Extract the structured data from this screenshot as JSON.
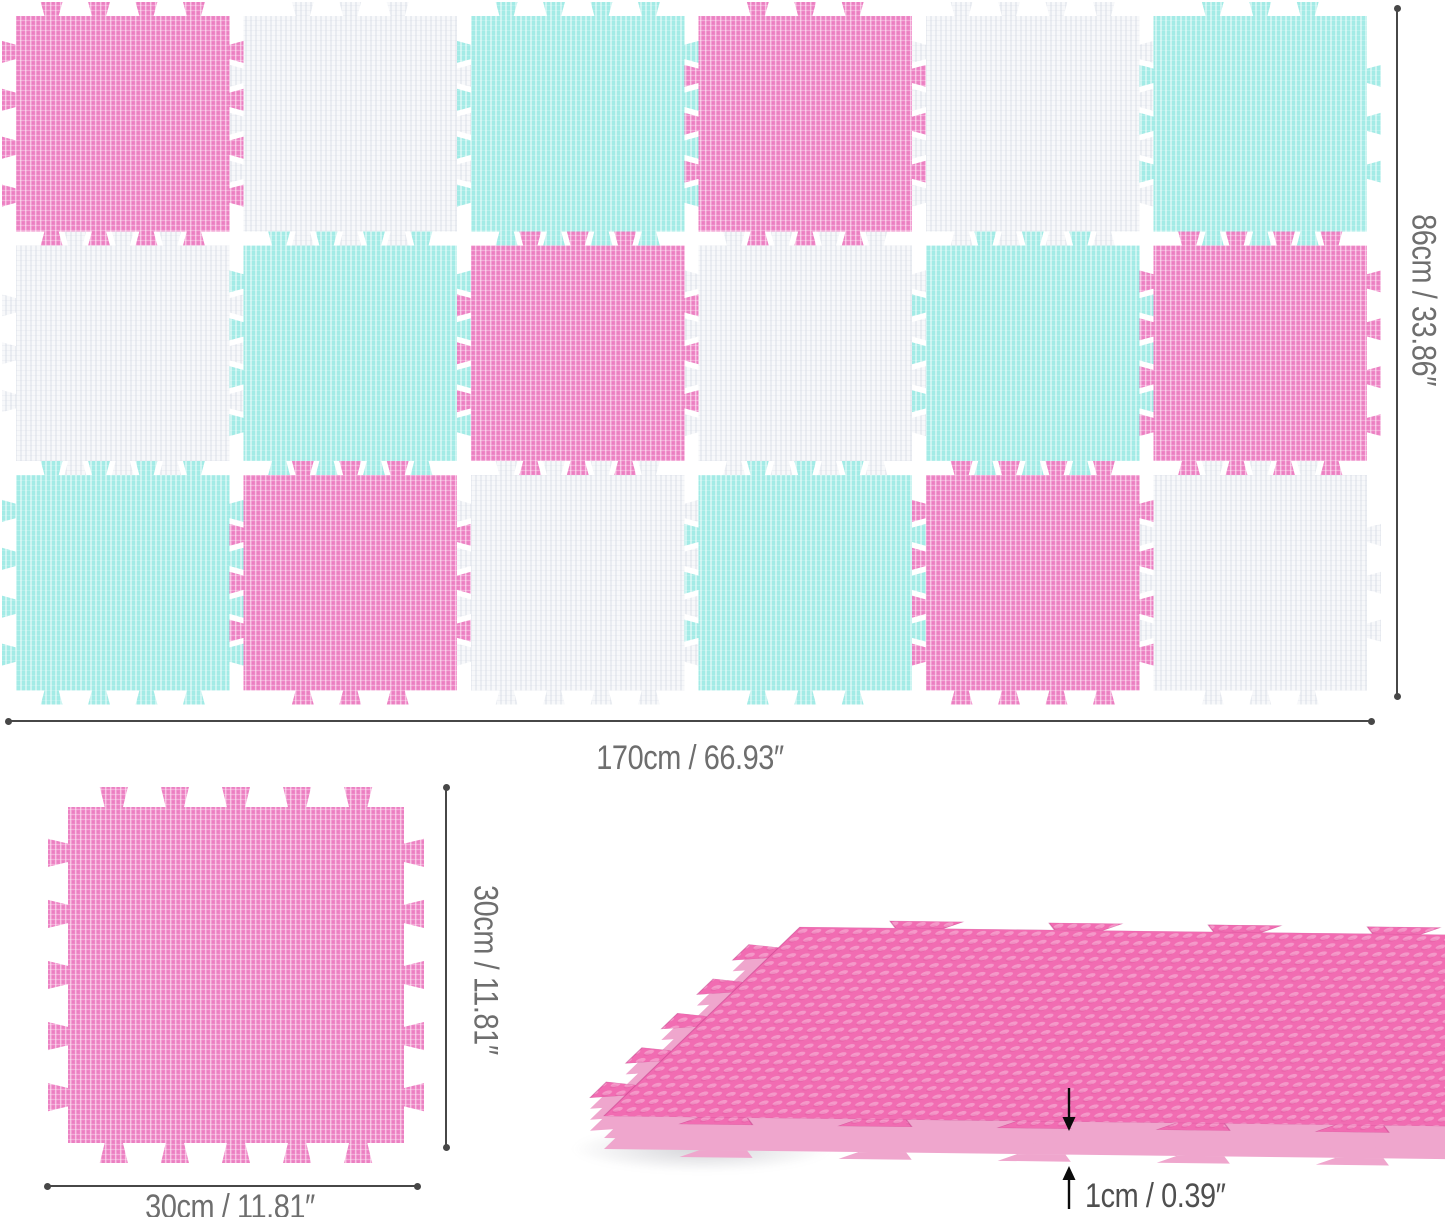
{
  "colors": {
    "pink": "#ee86c6",
    "teal": "#a3ebe6",
    "white": "#f7f8fa",
    "pink_3d_top": "#f16cb2",
    "pink_3d_side": "#efa6cd",
    "dimension_line": "#474747",
    "label_text": "#6e6e6e",
    "arrow": "#0b0b0b"
  },
  "assembled_mat": {
    "rows": 3,
    "cols": 6,
    "tile_pattern": [
      [
        "pink",
        "white",
        "teal",
        "pink",
        "white",
        "teal"
      ],
      [
        "white",
        "teal",
        "pink",
        "white",
        "teal",
        "pink"
      ],
      [
        "teal",
        "pink",
        "white",
        "teal",
        "pink",
        "white"
      ]
    ],
    "width_label": "170cm / 66.93″",
    "height_label": "86cm / 33.86″"
  },
  "single_tile": {
    "color": "pink",
    "width_label": "30cm / 11.81″",
    "height_label": "30cm / 11.81″"
  },
  "tile_side_view": {
    "color": "pink",
    "thickness_label": "1cm / 0.39″"
  }
}
